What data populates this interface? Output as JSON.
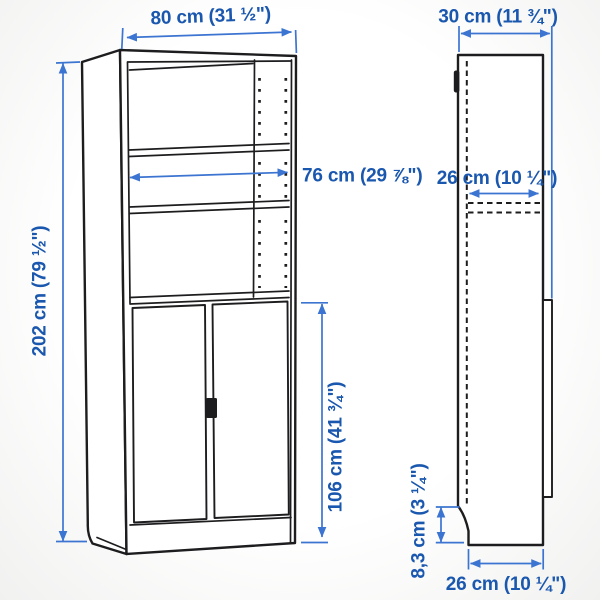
{
  "diagram": {
    "product": "bookcase-with-doors",
    "front_view": {
      "width": "80 cm (31 ½\")",
      "inner_width": "76 cm (29 ⅞\")",
      "height": "202 cm (79 ½\")",
      "door_height": "106 cm (41 ¾\")"
    },
    "side_view": {
      "depth": "30 cm (11 ¾\")",
      "inner_depth": "26 cm (10 ¼\")",
      "plinth_height": "8,3 cm (3 ¼\")",
      "bottom_depth": "26 cm (10 ¼\")"
    },
    "colors": {
      "dimension_blue": "#3c74d1",
      "label_blue": "#1a57ae",
      "outline_black": "#1d1d1f"
    }
  }
}
